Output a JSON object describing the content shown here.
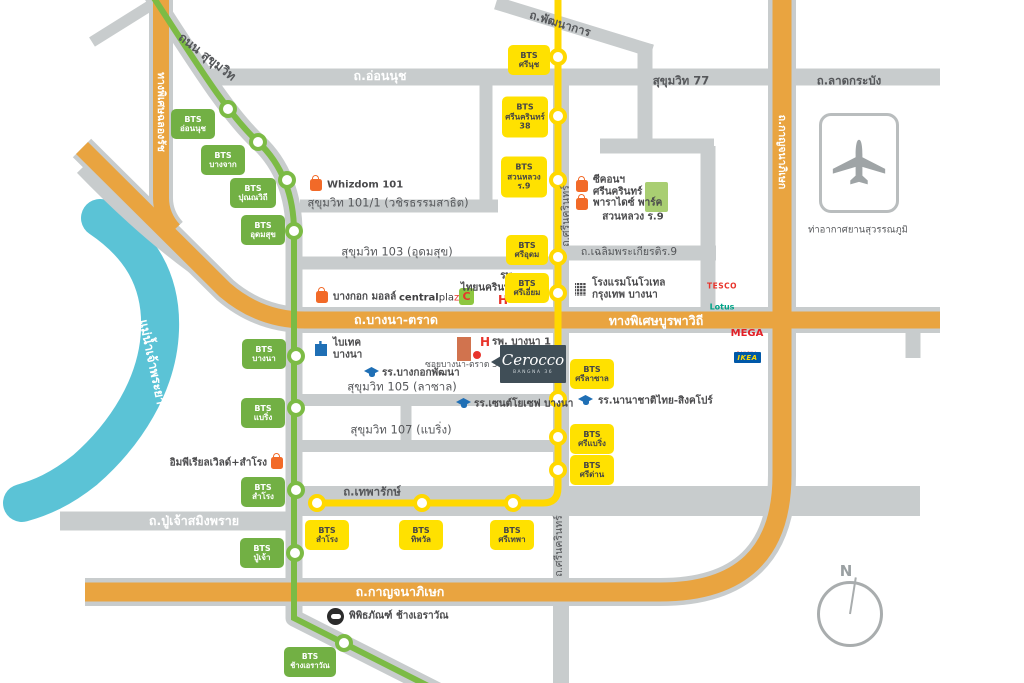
{
  "project": {
    "name": "Cerocco",
    "subtitle": "BANGNA 36"
  },
  "compass": {
    "north_label": "N"
  },
  "airport": {
    "label": "ท่าอากาศยานสุวรรณภูมิ"
  },
  "river": {
    "label": "แม่น้ำเจ้าพระยา"
  },
  "colors": {
    "road_gray": "#C8CCCD",
    "expressway_orange": "#E9A440",
    "bts_green_line": "#7CBB45",
    "bts_green_box": "#72B044",
    "bts_yellow_line": "#FFD800",
    "bts_yellow_box": "#FFE100",
    "river_blue": "#5BC3D6",
    "park_green": "#A9CE72",
    "label_dark": "#55575A",
    "landmark_orange": "#F26A28",
    "hospital_red": "#E8342C",
    "school_blue": "#1F6FB5",
    "logo_slate": "#404E57"
  },
  "roads": {
    "sukhumvit": "ถนน สุขุมวิท",
    "onnut": "ถ.อ่อนนุช",
    "phatthanakan": "ถ.พัฒนาการ",
    "sukhumvit77": "สุขุมวิท 77",
    "latkrabang": "ถ.ลาดกระบัง",
    "chalongrat": "ทางพิเศษฉลองรัช",
    "soi101": "สุขุมวิท 101/1 (วชิรธรรมสาธิต)",
    "soi103": "สุขุมวิท 103 (อุดมสุข)",
    "srinakarin_top": "ถ.ศรีนครินทร์",
    "chalermprakiat": "ถ.เฉลิมพระเกียรติร.9",
    "bangnatrat": "ถ.บางนา-ตราด",
    "buraphawithi": "ทางพิเศษบูรพาวิถี",
    "kanchanaphisek_v": "ถ.กาญจนาภิเษก",
    "soi105": "สุขุมวิท 105 (ลาซาล)",
    "soi107": "สุขุมวิท 107 (แบริ่ง)",
    "theparak": "ถ.เทพารักษ์",
    "srinakarin_bottom": "ถ.ศรีนครินทร์",
    "puchao": "ถ.ปู่เจ้าสมิงพราย",
    "kanchanaphisek_h": "ถ.กาญจนาภิเษก",
    "soi_bangna_trat36": "ซอยบางนา-ตราด 36"
  },
  "stations": {
    "green": [
      {
        "label": "BTS\nอ่อนนุช"
      },
      {
        "label": "BTS\nบางจาก"
      },
      {
        "label": "BTS\nปุณณวิถี"
      },
      {
        "label": "BTS\nอุดมสุข"
      },
      {
        "label": "BTS\nบางนา"
      },
      {
        "label": "BTS\nแบริ่ง"
      },
      {
        "label": "BTS\nสำโรง"
      },
      {
        "label": "BTS\nปู่เจ้า"
      },
      {
        "label": "BTS\nช้างเอราวัณ"
      }
    ],
    "yellow": [
      {
        "label": "BTS\nศรีนุช"
      },
      {
        "label": "BTS\nศรีนครินทร์\n38"
      },
      {
        "label": "BTS\nสวนหลวง\nร.9"
      },
      {
        "label": "BTS\nศรีอุดม"
      },
      {
        "label": "BTS\nศรีเอี่ยม"
      },
      {
        "label": "BTS\nศรีลาซาล"
      },
      {
        "label": "BTS\nศรีแบริ่ง"
      },
      {
        "label": "BTS\nศรีด่าน"
      },
      {
        "label": "BTS\nศรีเทพา"
      },
      {
        "label": "BTS\nทิพวัล"
      },
      {
        "label": "BTS\nสำโรง"
      }
    ]
  },
  "landmarks": {
    "whizdom": "Whizdom 101",
    "bangkok_mall": "บางกอก มอลล์",
    "centralplaza": {
      "part1": "central",
      "part2": "pla",
      "part3": "z",
      "part4": "a",
      "c_badge": "C"
    },
    "thainakarin": "รพ.\nไทยนครินทร์",
    "hospital_h": "H",
    "seacon": "ซีคอนฯ\nศรีนครินทร์",
    "paradise": "พาราไดซ์ พาร์ค",
    "suanluang": "สวนหลวง ร.9",
    "novotel": "โรงแรมโนโวเทล\nกรุงเทพ บางนา",
    "tesco": {
      "line1": "TESCO",
      "line2": "Lotus"
    },
    "bitec": "ไบเทค\nบางนา",
    "bangkok_patana": "รร.บางกอกพัฒนา",
    "bangna1": "รพ. บางนา 1",
    "st_joseph": "รร.เซนต์โยเซฟ บางนา",
    "thai_singapore": "รร.นานาชาติไทย-สิงคโปร์",
    "mega": {
      "line1": "MEGA",
      "line2": "BANGNA"
    },
    "ikea": "IKEA",
    "imperial": "อิมพีเรียลเวิลด์+สำโรง",
    "erawan_museum": "พิพิธภัณฑ์ ช้างเอราวัณ"
  }
}
